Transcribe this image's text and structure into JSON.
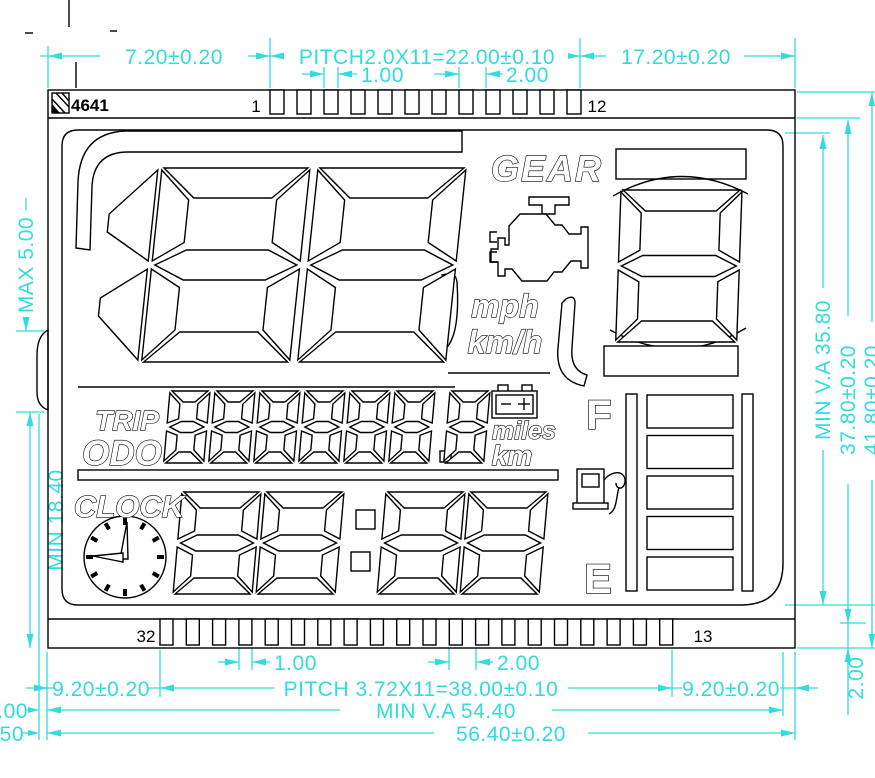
{
  "title_block": {
    "part_number": "4641"
  },
  "pins": {
    "top_first_label": "1",
    "top_last_label": "12",
    "bottom_left_label": "32",
    "bottom_right_label": "13",
    "top_count": 12,
    "bottom_count": 20
  },
  "dimensions": {
    "top_left": "7.20±0.20",
    "top_pitch": "PITCH2.0X11=22.00±0.10",
    "top_pin_width": "1.00",
    "top_pin_pitch": "2.00",
    "top_right": "17.20±0.20",
    "left_max": "MAX  5.00",
    "left_min": "MIN  18.40",
    "right_va": "MIN V.A 35.80",
    "right_height": "37.80±0.20",
    "right_outer_height": "41.80±0.20",
    "right_bottom_strip": "2.00",
    "bottom_pin_width": "1.00",
    "bottom_pin_pitch": "2.00",
    "bottom_left": "9.20±0.20",
    "bottom_pitch": "PITCH  3.72X11=38.00±0.10",
    "bottom_right": "9.20±0.20",
    "bottom_va": "MIN  V.A  54.40",
    "bottom_width": "56.40±0.20",
    "edge_clipped_upper": ".00",
    "edge_clipped_lower": "50"
  },
  "lcd": {
    "gear_label": "GEAR",
    "mph_label": "mph",
    "kmh_label": "km/h",
    "trip_label": "TRIP",
    "odo_label": "ODO",
    "miles_label": "miles",
    "km_label": "km",
    "clock_label": "CLOCK",
    "fuel_full_label": "F",
    "fuel_empty_label": "E",
    "speed_value": "188",
    "gear_value": "8",
    "odo_value": "888888.8",
    "clock_value": "88:88",
    "fuel_segments": 5
  },
  "colors": {
    "dimension": "#32DCDC",
    "line": "#000000",
    "background": "#FFFFFF"
  }
}
